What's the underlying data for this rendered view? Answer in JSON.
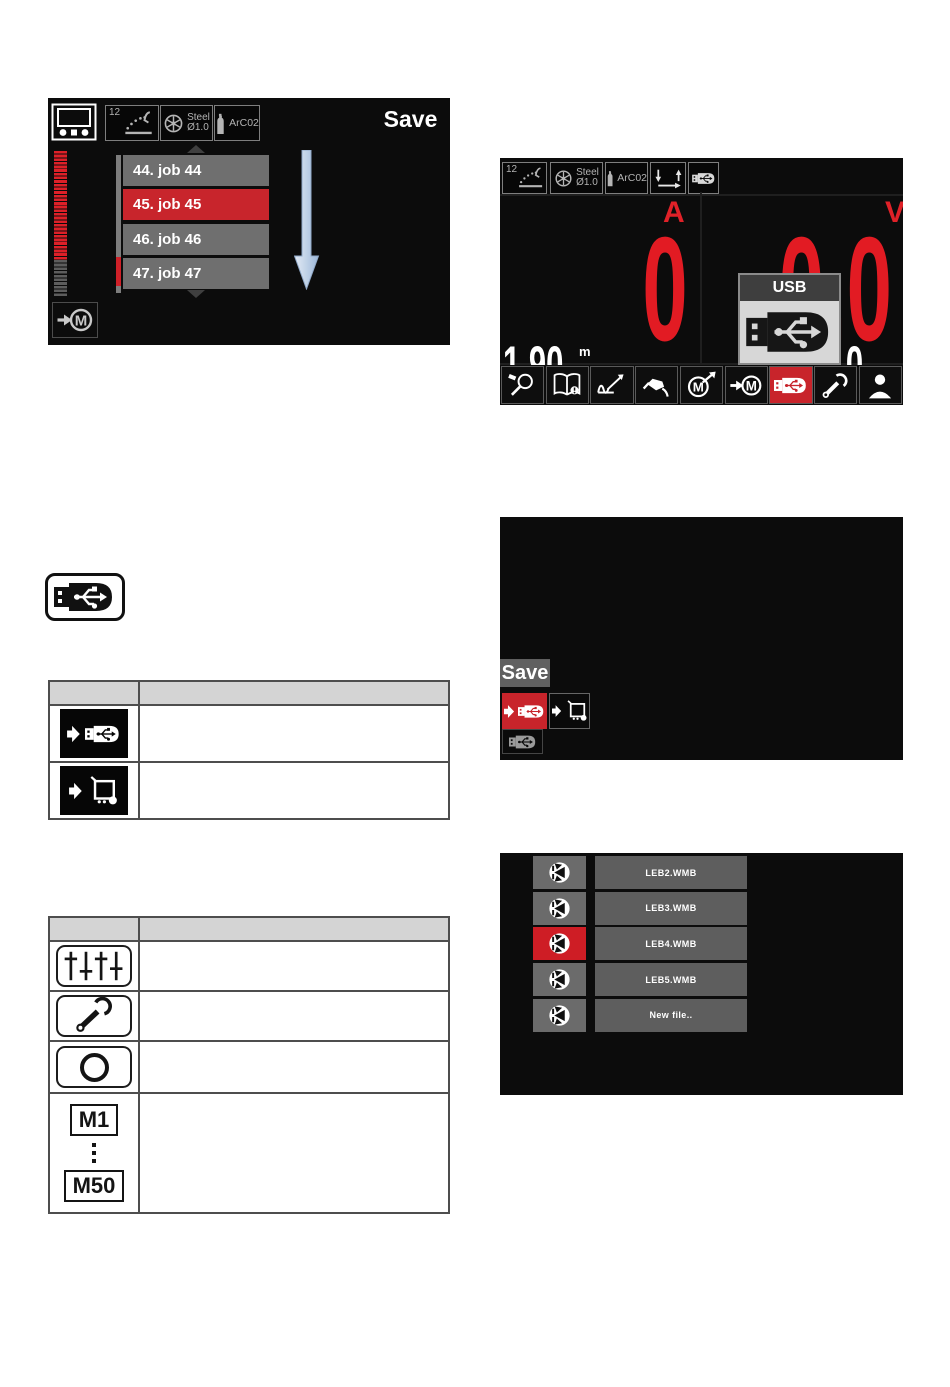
{
  "screen_jobs": {
    "title": "Save",
    "top_bar": {
      "process_number": "12",
      "material": "Steel",
      "wire_diameter": "Ø1.0",
      "gas": "ArC02"
    },
    "jobs": [
      {
        "label": "44. job 44",
        "selected": false
      },
      {
        "label": "45. job 45",
        "selected": true
      },
      {
        "label": "46. job 46",
        "selected": false
      },
      {
        "label": "47. job 47",
        "selected": false
      }
    ]
  },
  "screen_main": {
    "top_bar": {
      "process_number": "12",
      "material": "Steel",
      "wire_diameter": "Ø1.0",
      "gas": "ArC02"
    },
    "left_display": {
      "label": "A",
      "value": "0",
      "secondary_value": "1.90",
      "secondary_unit": "m"
    },
    "right_display": {
      "label": "V",
      "value": "0.0",
      "secondary_value": "1.0"
    },
    "usb_popup": {
      "title": "USB"
    },
    "toolbar": [
      {
        "name": "torch-test",
        "active": false
      },
      {
        "name": "manual-info",
        "active": false
      },
      {
        "name": "process-graph",
        "active": false
      },
      {
        "name": "torch",
        "active": false
      },
      {
        "name": "memory-save",
        "active": false
      },
      {
        "name": "memory-load",
        "active": false
      },
      {
        "name": "usb",
        "active": true
      },
      {
        "name": "settings-wrench",
        "active": false
      },
      {
        "name": "user",
        "active": false
      }
    ]
  },
  "screen_save_menu": {
    "save_label": "Save"
  },
  "screen_files": {
    "files": [
      {
        "name": "LEB2.WMB",
        "selected": false
      },
      {
        "name": "LEB3.WMB",
        "selected": false
      },
      {
        "name": "LEB4.WMB",
        "selected": true
      },
      {
        "name": "LEB5.WMB",
        "selected": false
      },
      {
        "name": "New file..",
        "selected": false
      }
    ]
  },
  "tables": {
    "usb_actions": {
      "header": [
        "",
        ""
      ],
      "rows": [
        {
          "icon": "save-to-usb",
          "description": ""
        },
        {
          "icon": "load-to-machine",
          "description": ""
        }
      ]
    },
    "settings": {
      "header": [
        "",
        ""
      ],
      "rows": [
        {
          "icon": "sliders",
          "description": ""
        },
        {
          "icon": "wrench",
          "description": ""
        },
        {
          "icon": "circle",
          "description": ""
        },
        {
          "icon": "memory-range",
          "first": "M1",
          "last": "M50",
          "description": ""
        }
      ]
    }
  },
  "colors": {
    "accent_red": "#c8242b",
    "selected_red": "#ce1d25",
    "screen_bg": "#0c0c0c",
    "row_gray": "#6f6f6f",
    "popup_gray": "#d7d7d7"
  }
}
